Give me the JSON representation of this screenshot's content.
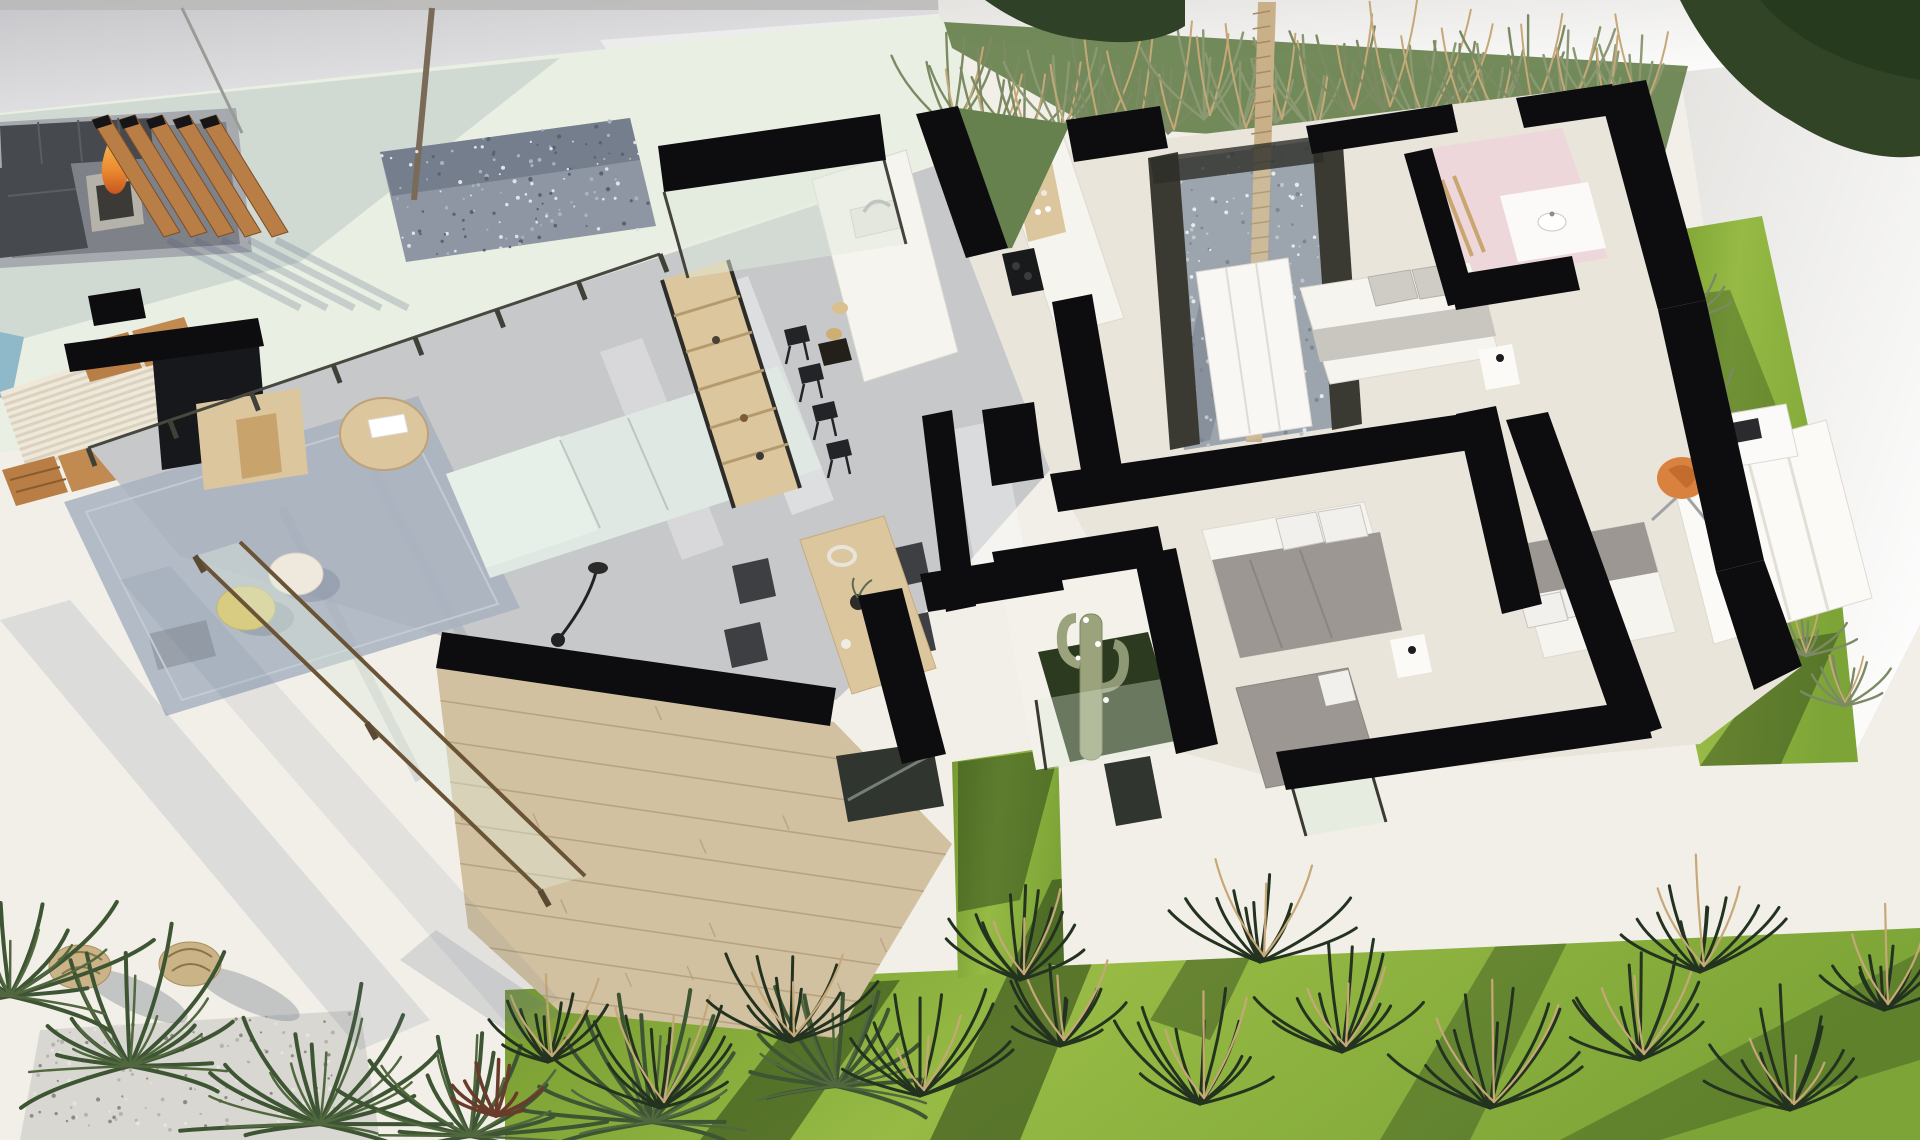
{
  "meta": {
    "title": "Aerial 3D cutaway render of a modern single-storey villa floor plan with terrace and garden"
  },
  "palette": {
    "terrace": "#f2efe8",
    "wallLight": "#efeeec",
    "wallShade": "#c9c9cd",
    "patioTint": "#e9efe3",
    "floorGray": "#c7c8ca",
    "floorCream": "#eae5da",
    "wallBlack": "#0d0d10",
    "stone": "#d2c1a0",
    "stoneDark": "#b19e7c",
    "woodWarm": "#b97e45",
    "woodLight": "#dcc69e",
    "deckCream": "#efe8d8",
    "mint": "#dfe8e2",
    "rug": "#a8b1c0",
    "charcoal": "#3d3f42",
    "darkSofa": "#46494e",
    "fire": "#e8913a",
    "poufYellow": "#d8cc82",
    "poufWhite": "#efe9dd",
    "linenWhite": "#f6f4ef",
    "duvetGray": "#9c9792",
    "pillowGray": "#cfcbc5",
    "orangeChair": "#d9813f",
    "pink": "#eed7da",
    "gravelBlue": "#8e96a3",
    "gravelLight": "#d9d7d1",
    "cactus": "#9aa37c",
    "cactusGround": "#2c3b20",
    "lawn": "#88ad3c",
    "lawnShade": "#2e471a",
    "plantOlive": "#7c8a63",
    "plumeTan": "#c6a878",
    "palmDark": "#3e5534",
    "redPlant": "#6a3b2a",
    "poolBlue": "#8fb9c9",
    "trunkTan": "#c9b089",
    "wicker": "#c9b387",
    "glassFrame": "#3a3a33",
    "paleGlass": "#dfeadb",
    "windowDark": "#31352f"
  },
  "scene": {
    "objects": [
      "boundary wall",
      "sunken outdoor lounge",
      "fire pit",
      "timber slat screen",
      "gravel courtyard with tree",
      "louvred pergola deck",
      "sun loungers",
      "plunge pool edge",
      "tv wall",
      "media console",
      "bookshelf",
      "l-shaped sofa",
      "round coffee table",
      "rug",
      "poufs",
      "kitchen island with sink",
      "bar stools",
      "back counter with cooktop",
      "dining table with four chairs",
      "interior palm courtyard",
      "interior cactus courtyard",
      "bedroom bed 1",
      "bedroom bed 2",
      "bedroom bed 3",
      "bedroom bed 4",
      "wardrobes",
      "desk with orange chair",
      "pink bathroom with vanity",
      "stone clad facade with window",
      "garden lawn",
      "ornamental grasses",
      "palm shrubs",
      "wicker lanterns",
      "gravel bed"
    ]
  }
}
